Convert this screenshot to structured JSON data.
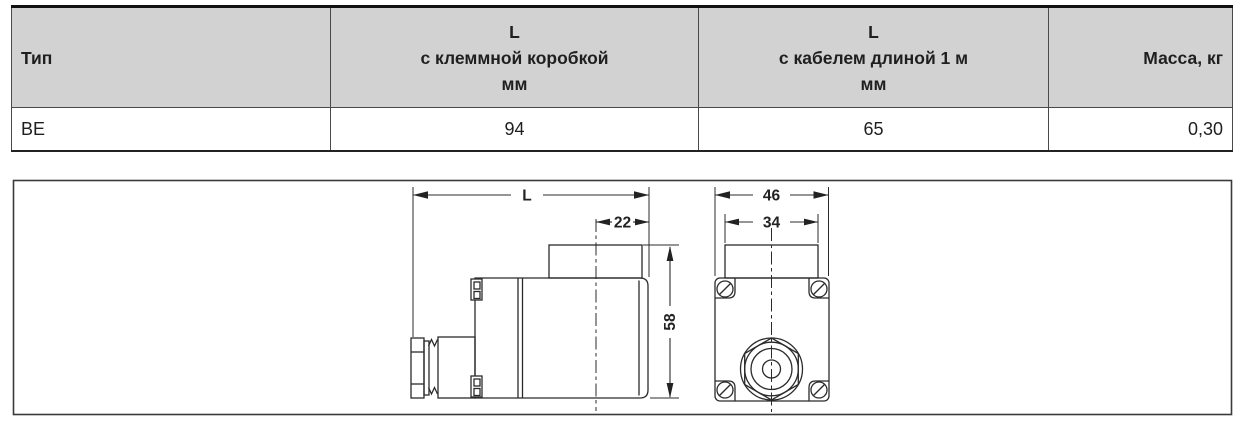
{
  "colors": {
    "header_bg": "#d2d2d2",
    "line": "#2b2b2b",
    "text": "#1f1f1f"
  },
  "table": {
    "header": {
      "col1": "Тип",
      "col2_line1": "L",
      "col2_line2": "с клеммной коробкой",
      "col2_line3": "мм",
      "col3_line1": "L",
      "col3_line2": "с кабелем длиной 1 м",
      "col3_line3": "мм",
      "col4": "Масса, кг"
    },
    "row": {
      "type": "BE",
      "l_terminal_box": "94",
      "l_cable": "65",
      "mass": "0,30"
    }
  },
  "drawing": {
    "dim_length": "L",
    "dim_cap_offset": "22",
    "dim_height": "58",
    "dim_width_outer": "46",
    "dim_width_cap": "34"
  }
}
